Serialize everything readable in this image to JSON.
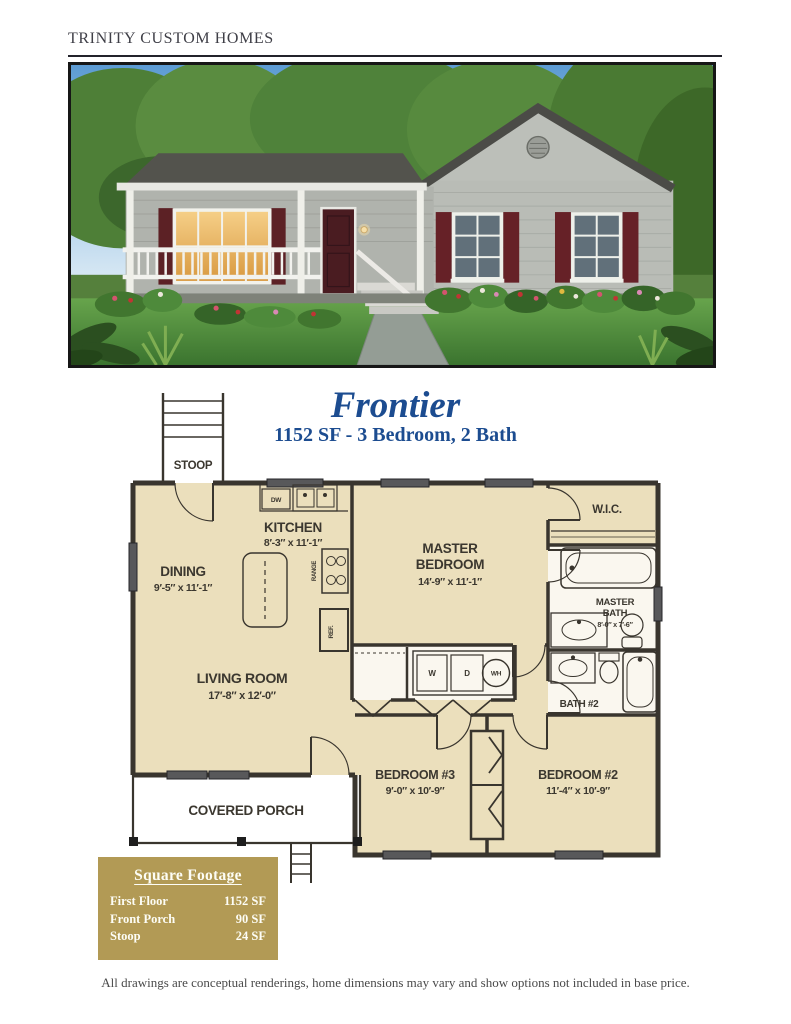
{
  "brand": "TRINITY CUSTOM HOMES",
  "plan": {
    "title": "Frontier",
    "subtitle": "1152 SF - 3 Bedroom, 2 Bath"
  },
  "floorplan": {
    "stoop": "STOOP",
    "kitchen": {
      "name": "KITCHEN",
      "dims": "8′-3″ x 11′-1″"
    },
    "dining": {
      "name": "DINING",
      "dims": "9′-5″ x 11′-1″"
    },
    "master_bedroom": {
      "line1": "MASTER",
      "line2": "BEDROOM",
      "dims": "14′-9″ x 11′-1″"
    },
    "wic": {
      "name": "W.I.C."
    },
    "master_bath": {
      "line1": "MASTER",
      "line2": "BATH",
      "dims": "8′-0″ x 7′-6″"
    },
    "bath2": {
      "name": "BATH #2"
    },
    "living_room": {
      "name": "LIVING ROOM",
      "dims": "17′-8″ x 12′-0″"
    },
    "bedroom3": {
      "name": "BEDROOM #3",
      "dims": "9′-0″ x 10′-9″"
    },
    "bedroom2": {
      "name": "BEDROOM #2",
      "dims": "11′-4″ x 10′-9″"
    },
    "covered_porch": "COVERED PORCH",
    "fixtures": {
      "dishwasher": "DW",
      "range": "RANGE",
      "refrigerator": "REF.",
      "washer": "W",
      "dryer": "D",
      "water_heater": "WH"
    }
  },
  "square_footage": {
    "title": "Square Footage",
    "rows": [
      {
        "label": "First Floor",
        "value": "1152 SF"
      },
      {
        "label": "Front Porch",
        "value": "90 SF"
      },
      {
        "label": "Stoop",
        "value": "24 SF"
      }
    ]
  },
  "disclaimer": "All drawings are conceptual renderings, home dimensions may vary and show options not included in base price.",
  "colors": {
    "accent_blue": "#1c4c90",
    "table_gold": "#b29a55",
    "plan_fill": "#ebdfbc",
    "wall": "#39352e",
    "shutter_red": "#5c2125"
  }
}
